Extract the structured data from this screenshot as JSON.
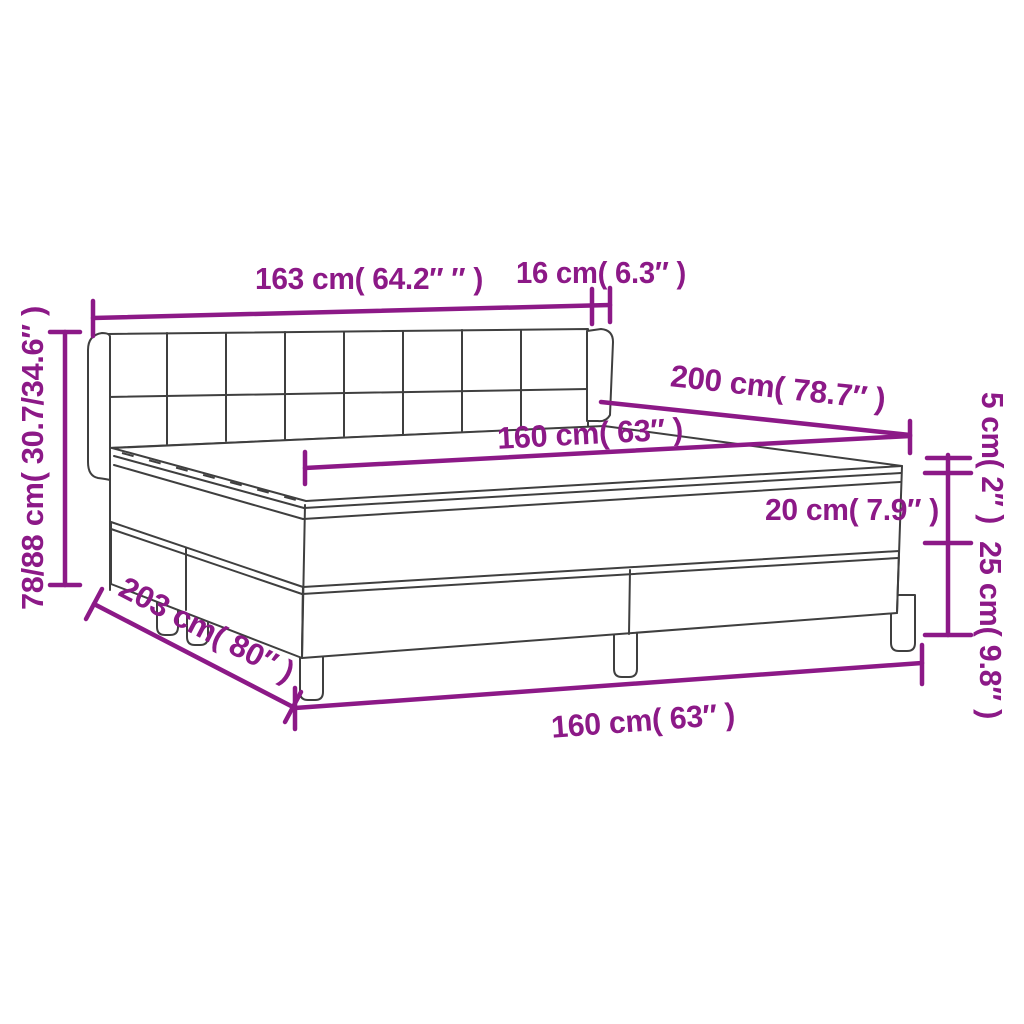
{
  "diagram": {
    "accent_color": "#8c1987",
    "line_color": "#3f3f3f",
    "background_color": "#ffffff",
    "labels": {
      "headboard_width": "163 cm( 64.2″ ″ )",
      "wing_depth": "16 cm( 6.3″ )",
      "height_range": "78/88 cm( 30.7/34.6″ )",
      "bed_length": "200 cm( 78.7″ )",
      "mattress_width_top": "160 cm( 63″ )",
      "topper_height": "5 cm( 2″ )",
      "mattress_height": "20 cm( 7.9″ )",
      "base_height": "25 cm( 9.8″ )",
      "total_length": "203 cm( 80″ )",
      "mattress_width_bottom": "160 cm( 63″ )"
    }
  }
}
